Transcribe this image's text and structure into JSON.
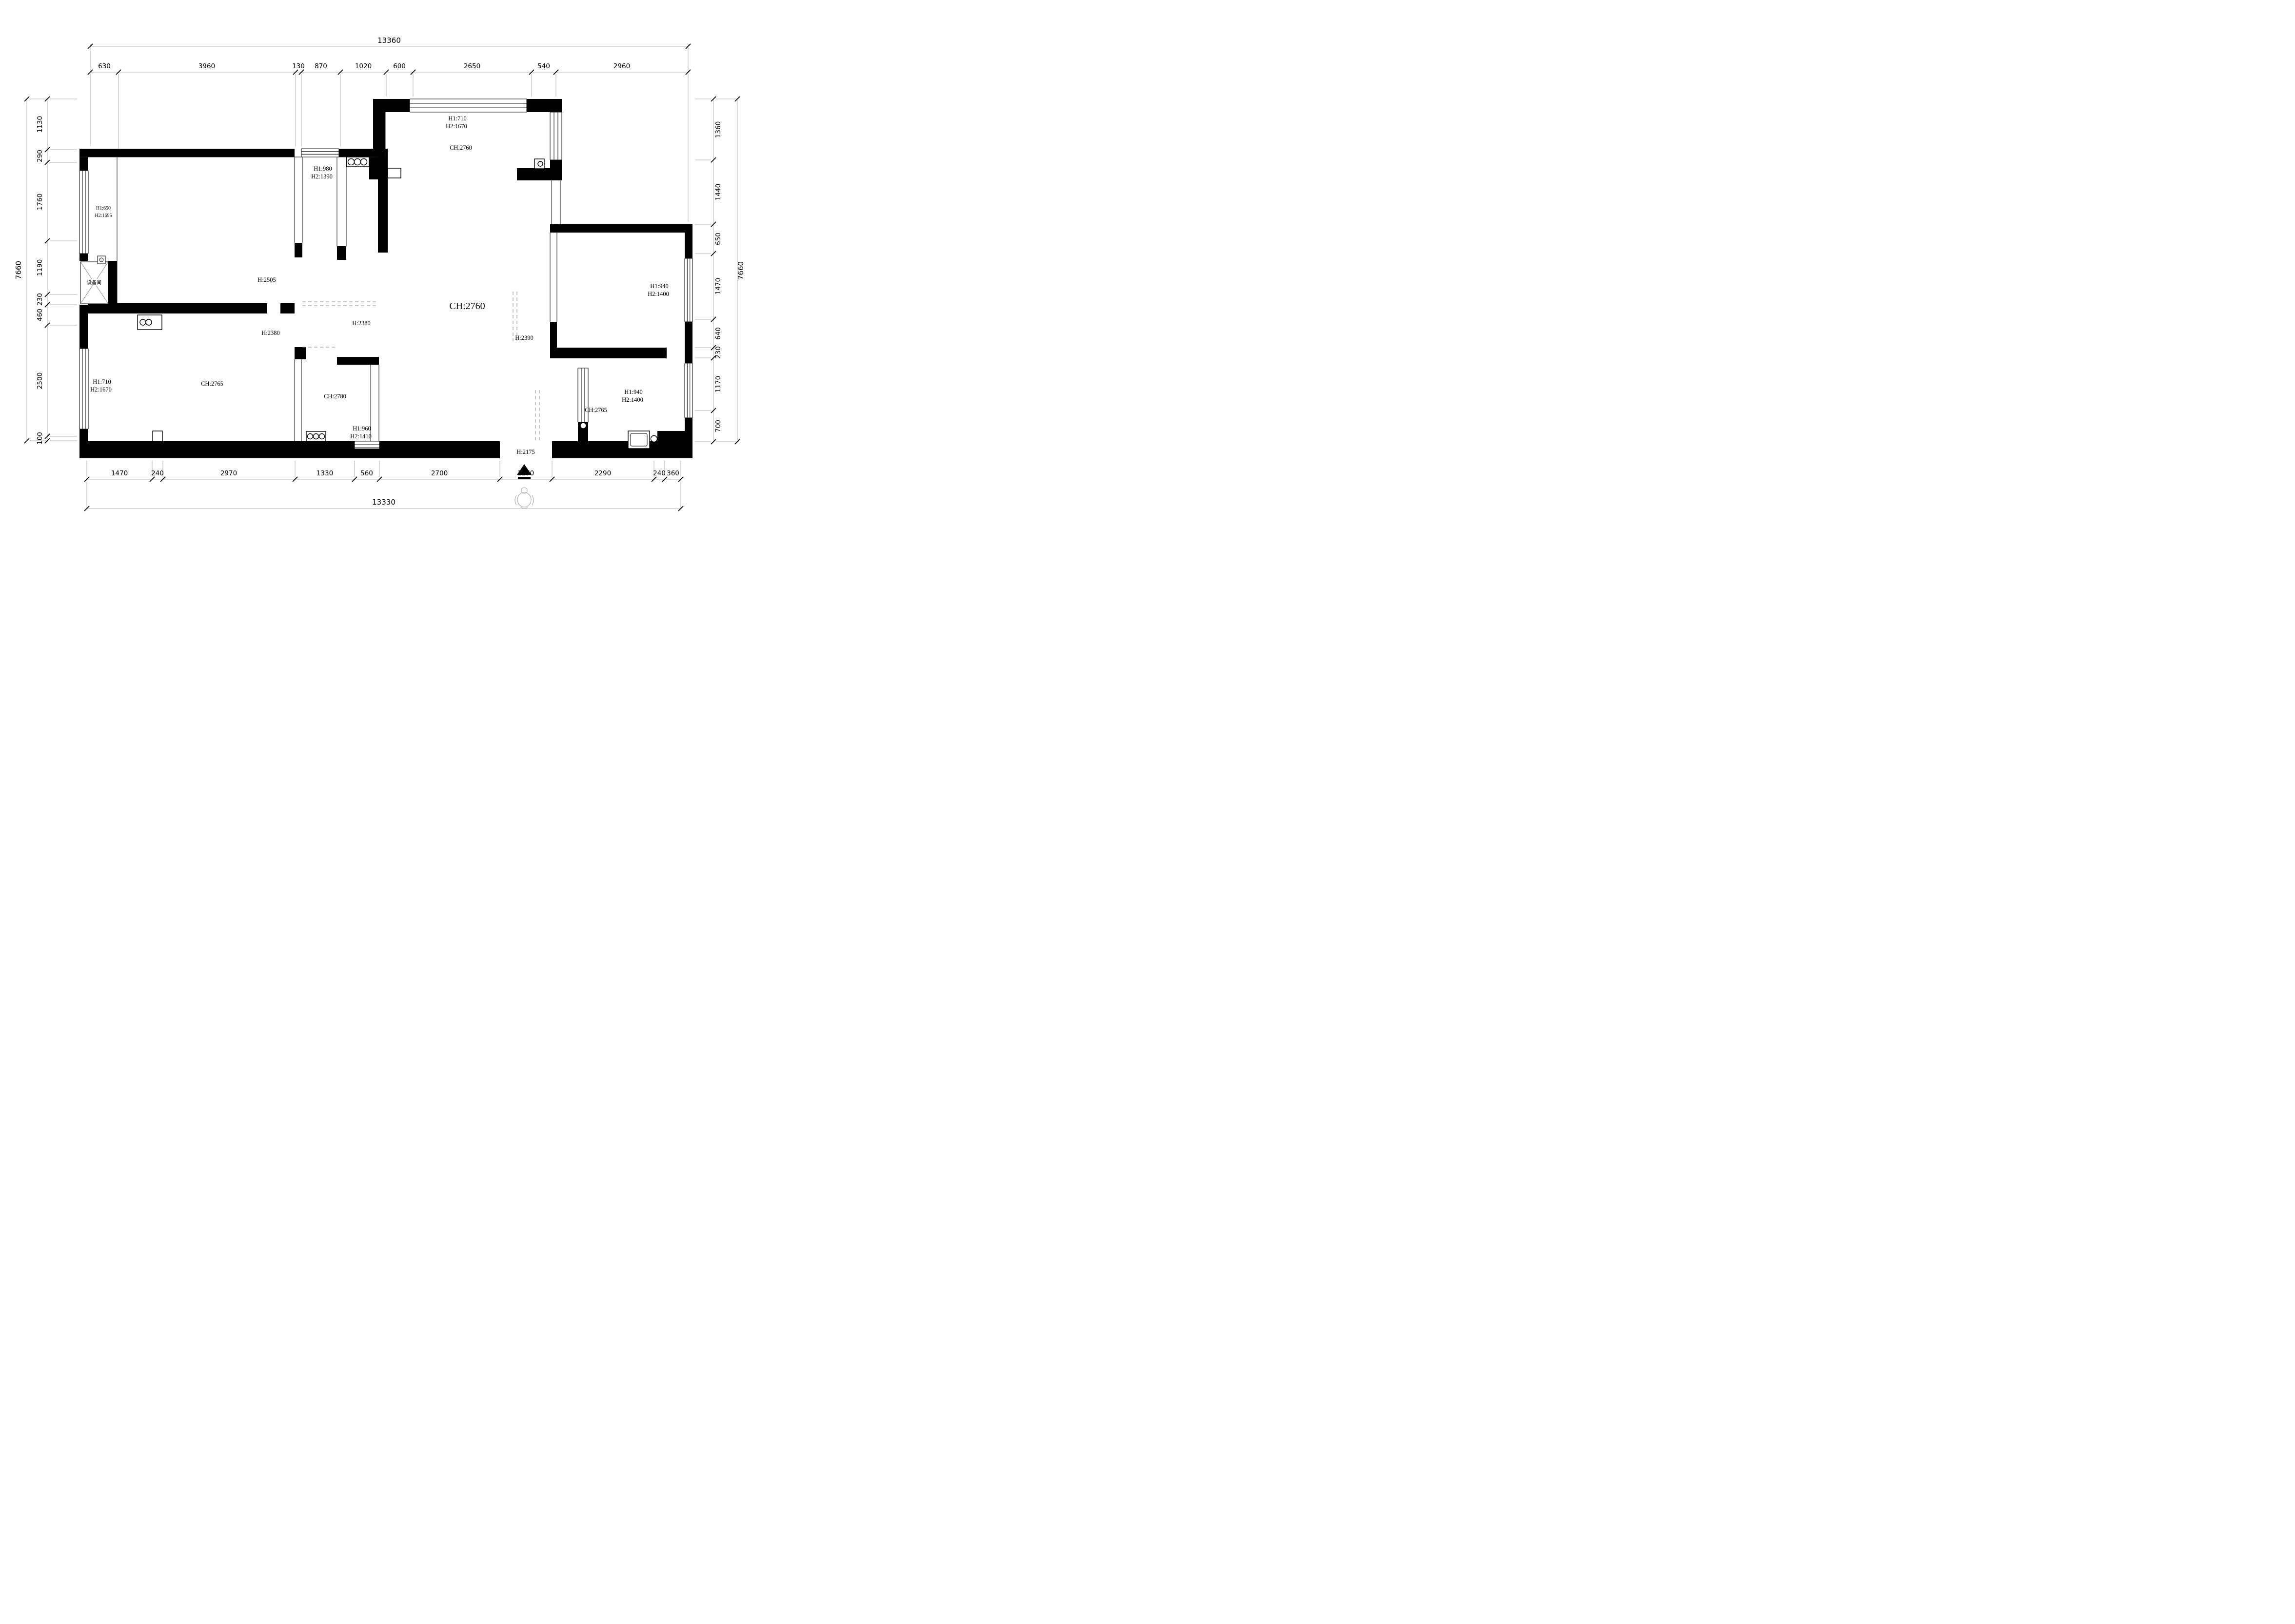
{
  "drawing": {
    "kind": "apartment floor plan with dimension chains",
    "colors": {
      "ink": "#000000",
      "paper": "#ffffff"
    }
  },
  "dims": {
    "top": {
      "total": "13360",
      "segments": [
        "630",
        "3960",
        "130",
        "870",
        "1020",
        "600",
        "2650",
        "540",
        "2960"
      ]
    },
    "bottom": {
      "total": "13330",
      "segments": [
        "1470",
        "240",
        "2970",
        "1330",
        "560",
        "2700",
        "1170",
        "2290",
        "240",
        "360"
      ]
    },
    "left": {
      "total": "7660",
      "segments": [
        "1130",
        "290",
        "1760",
        "1190",
        "230",
        "460",
        "2500",
        "100"
      ]
    },
    "right": {
      "total": "7660",
      "segments": [
        "1360",
        "1440",
        "650",
        "1470",
        "640",
        "230",
        "1170",
        "700"
      ]
    }
  },
  "labels": {
    "window_top_mid": [
      "H1:710",
      "H2:1670"
    ],
    "ceiling_top": "CH:2760",
    "window_top_left": [
      "H1:980",
      "H2:1390"
    ],
    "window_left_bay": [
      "H1:650",
      "H2:1695"
    ],
    "height_bedroom1": "H:2505",
    "equipment_room": "设备间",
    "height_hall_a": "H:2380",
    "height_hall_b": "H:2380",
    "ceiling_living": "CH:2760",
    "height_living_edge": "H:2390",
    "window_right_top": [
      "H1:940",
      "H2:1400"
    ],
    "ceiling_bedroom2": "CH:2765",
    "window_left_lower": [
      "H1:710",
      "H2:1670"
    ],
    "ceiling_bath": "CH:2780",
    "window_bottom_mid": [
      "H1:960",
      "H2:1410"
    ],
    "window_right_lower": [
      "H1:940",
      "H2:1400"
    ],
    "ceiling_bedroom3": "CH:2765",
    "entrance_height": "H:2175"
  }
}
